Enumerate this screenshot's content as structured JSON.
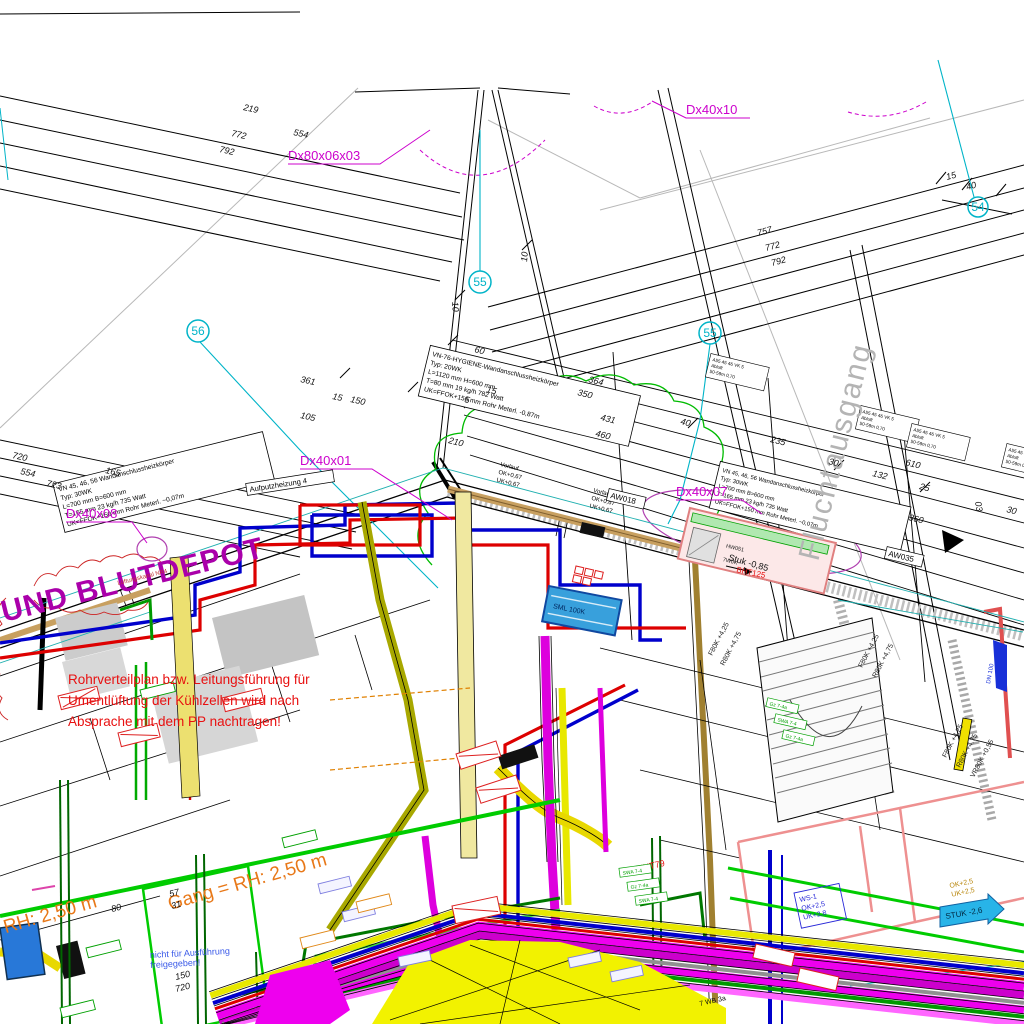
{
  "colors": {
    "duct_label": "#cc00cc",
    "grid_bubble": "#00b4c8",
    "red_note": "#e81010",
    "orange_note": "#e87818",
    "room_text": "#aa00aa",
    "flucht_text": "#b4b4b4",
    "pipe_red": "#dd0000",
    "pipe_blue": "#0000cc",
    "duct_magenta": "#dd00dd",
    "duct_yellow": "#e8e800",
    "pipe_green": "#00bb00"
  },
  "ducts": {
    "d1": "Dx80x06x03",
    "d2": "Dx40x10",
    "d3": "Dx40x01",
    "d4": "Dx40x08",
    "d5": "Dx40x07"
  },
  "bubbles": {
    "b54": "54",
    "b55": "55",
    "b56": "56"
  },
  "rooms": {
    "blutdepot": "UND BLUTDEPOT",
    "flucht": "Fluchtausgang",
    "gang": "Gang = RH: 2,50 m"
  },
  "notes": {
    "r1": "Rohrverteilplan bzw. Leitungsführung für",
    "r2": "Umentlüftung der Kühlzellen wird nach",
    "r3": "Absprache mit dem PP nachtragen!",
    "b1": "nicht für Ausführung",
    "b2": "freigegeben!"
  },
  "dims": {
    "d219": "219",
    "d772": "772",
    "d792": "792",
    "d554": "554",
    "d757": "757",
    "d15": "15",
    "d40": "40",
    "d720": "720",
    "d723": "723",
    "d165": "165",
    "d361": "361",
    "d105": "105",
    "d150": "150",
    "d60": "60",
    "d5": "5",
    "d210": "210",
    "d364": "364",
    "d350": "350",
    "d431": "431",
    "d460": "460",
    "d235": "235",
    "d30": "30",
    "d132": "132",
    "d610": "610",
    "d25": "25",
    "d360": "360",
    "d03": "03",
    "d10": "10",
    "d80": "80",
    "d57": "57",
    "d31": "31"
  },
  "specs": {
    "a1": "VN 45, 46, 56 Wandanschlussheizkörper",
    "a2": "Typ: 30WK",
    "a3": "L=700 mm B=600 mm",
    "a4": "T=165 mm 23 kg/h 735 Watt",
    "a5": "UK=FFOK+150 mm   Rohr Meterl. ~0,07m",
    "b1": "VN-76-HYGIENE-Wandanschlussheizkörper",
    "b2": "Typ: 20WK",
    "b3": "L=1120 mm H=600 mm",
    "b4": "T=80 mm 19 kg/h 782 Watt",
    "b5": "UK=FFOK+150 mm   Rohr Meterl. -0,87m",
    "v1": "Vorlauf",
    "v2": "OK+0,67",
    "v3": "UK+0,67",
    "s1": "A55 45 46 VK 5",
    "s2": "Abluft",
    "s3": "50-59m 0,70"
  },
  "tags": {
    "aw018": "AW018",
    "aw035": "AW035",
    "stuk085": "Stuk -0,85",
    "stuk26": "STUK -2,6",
    "ent79": "ENT79",
    "bht": "BHT125",
    "ws1": "WS-1",
    "ok25": "OK+2,5",
    "uk28": "UK+2,8",
    "uk25": "UK+2,5",
    "f80k": "F80K +4,25",
    "r80k": "R80K +4,75",
    "vr80k": "VR80K +0,55",
    "wb": "7 WB 3a",
    "sml": "SML 100K",
    "aufputz": "Aufputzheizung 4",
    "hw": "HW051",
    "wok": "7W0K",
    "lk": "Lüftungskanal NR4",
    "gz": "Gz 7-4a",
    "gz2": "SWA 7-4",
    "dn": "DN 100"
  }
}
